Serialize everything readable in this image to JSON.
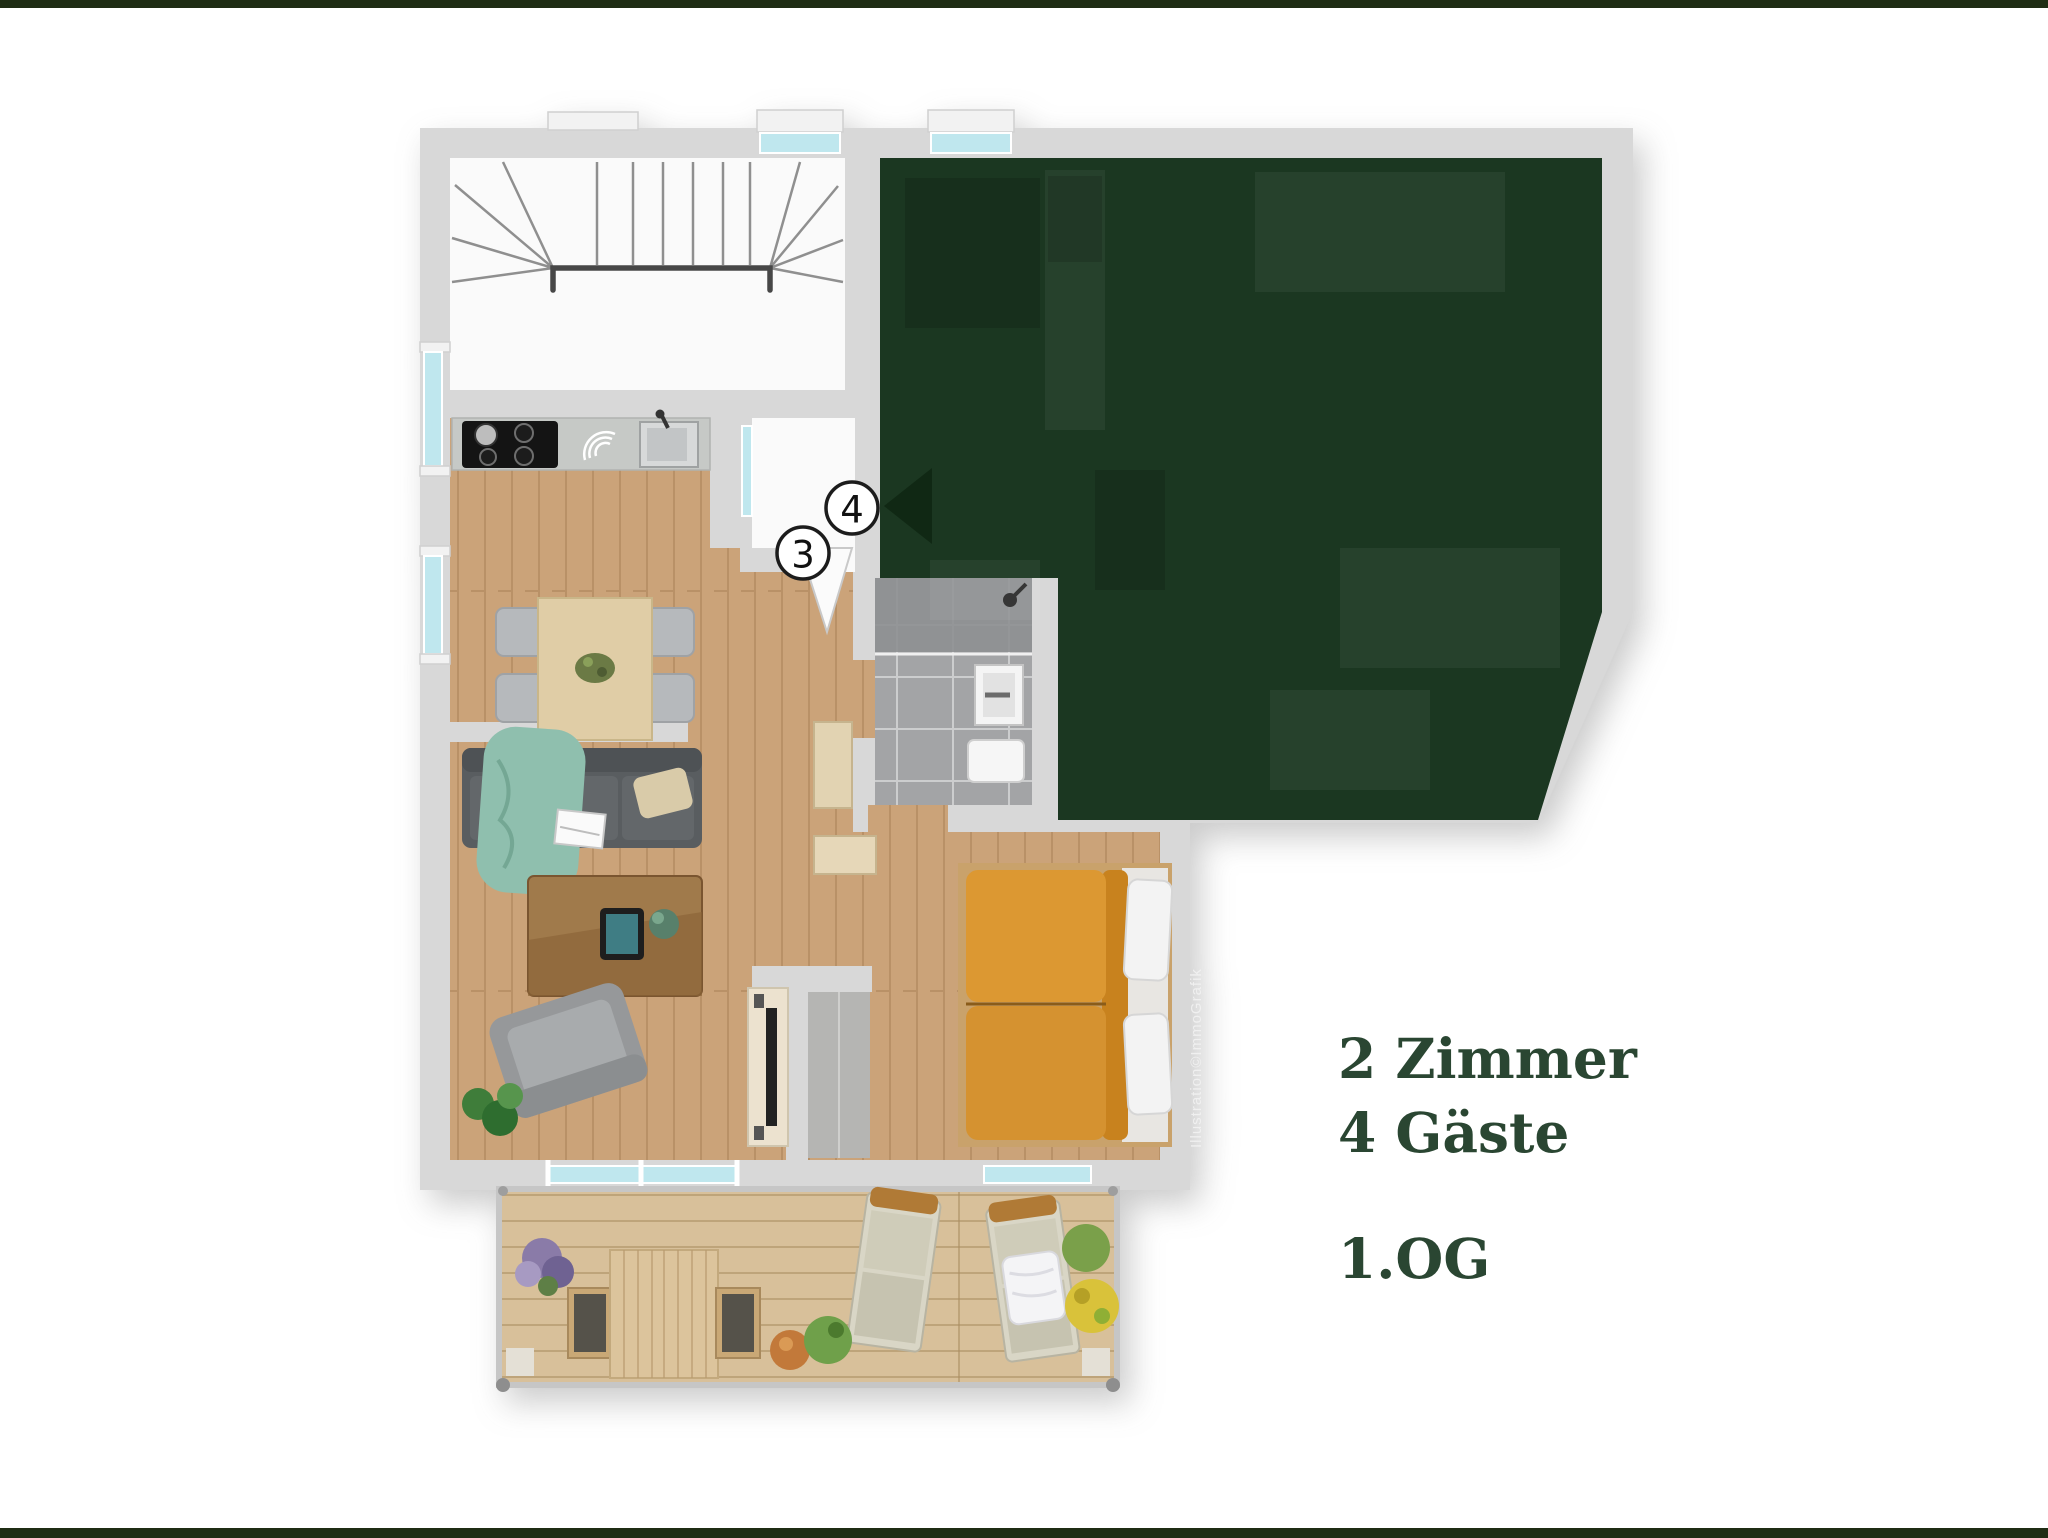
{
  "colors": {
    "top_bar": "#1f2d14",
    "bottom_bar": "#1f2d14",
    "accent_text": "#2a4632",
    "overlay_green": "#1b3721",
    "overlay_green_dark": "#102814",
    "wall": "#d8d8d8",
    "floor_wood": "#cba379",
    "floor_wood_line": "#8a6238",
    "deck_wood": "#d8c09a",
    "deck_wood_line": "#a98c60",
    "tile": "#a3a4a6",
    "glass": "#bfe7ee",
    "bed_orange": "#dc9832",
    "sofa_gray": "#595d60",
    "throw_teal": "#8fbfae"
  },
  "info_panel": {
    "line1": "2 Zimmer",
    "line2": "4 Gäste",
    "line3": "1.OG"
  },
  "plan": {
    "markers": [
      {
        "label": "3"
      },
      {
        "label": "4"
      }
    ],
    "watermark": "Illustration©ImmoGrafik"
  }
}
